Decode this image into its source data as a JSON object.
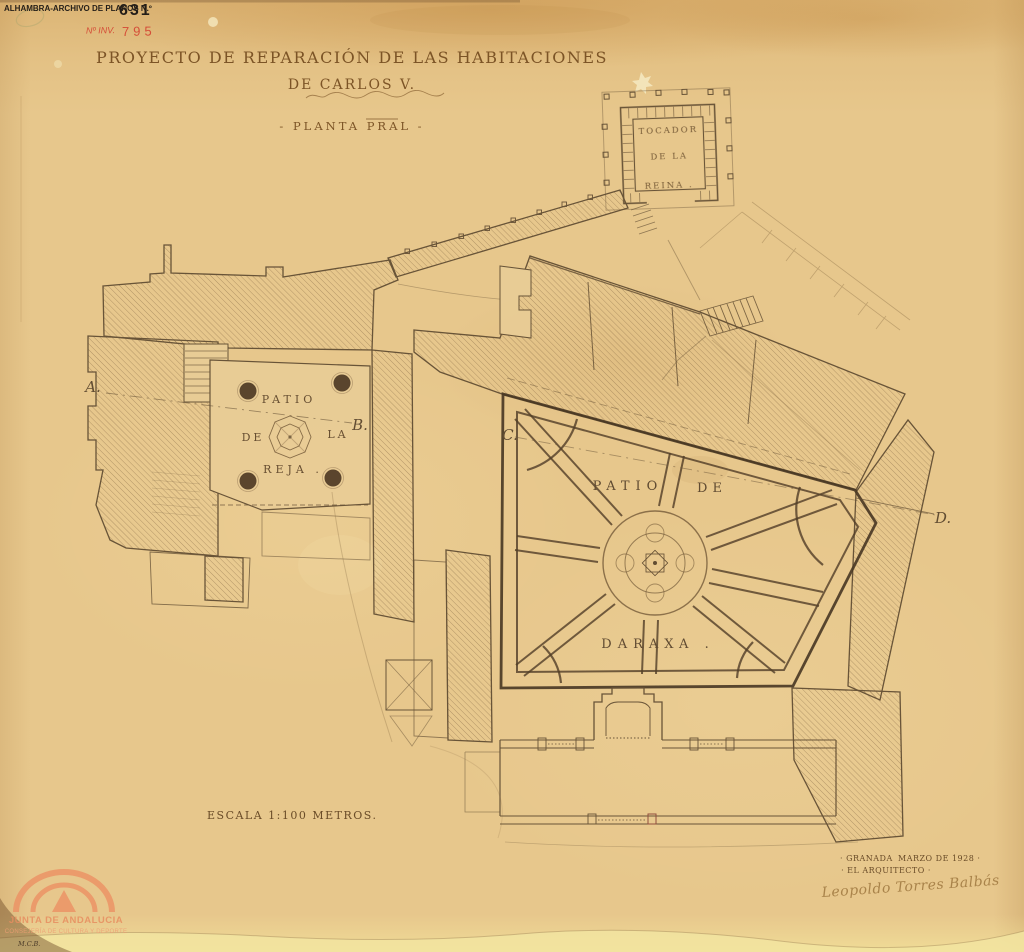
{
  "stamps": {
    "archive_label": "ALHAMBRA-ARCHIVO DE PLANOS N.º",
    "archive_number": "631",
    "inventory_label": "Nº INV.",
    "inventory_number": "795"
  },
  "title": {
    "line1": "PROYECTO DE REPARACIÓN DE LAS HABITACIONES",
    "line2": "DE CARLOS V.",
    "subtitle": "- PLANTA PRAL -"
  },
  "plan": {
    "tocador_l1": "TOCADOR",
    "tocador_l2": "DE LA",
    "tocador_l3": "REINA .",
    "reja_w1": "PATIO",
    "reja_w2": "DE",
    "reja_w3": "LA",
    "reja_w4": "REJA .",
    "daraxa_w1": "PATIO",
    "daraxa_w2": "DE",
    "daraxa_l2": "DARAXA .",
    "section_a": "A.",
    "section_b": "B.",
    "section_c": "C.",
    "section_d": "D.",
    "scale_note": "ESCALA 1:100 METROS."
  },
  "signature_block": {
    "place": "· GRANADA",
    "date": "MARZO DE 1928 ·",
    "role": "· EL ARQUITECTO ·",
    "signature": "Leopoldo Torres Balbás"
  },
  "watermark": {
    "org": "JUNTA DE ANDALUCIA",
    "dept": "CONSEJERÍA DE CULTURA Y DEPORTE",
    "initials": "M.C.B."
  },
  "colors": {
    "paper": "#e7c78c",
    "ink": "#5d4930",
    "ink_dark": "#3c2c1a",
    "stamp_black": "#241e18",
    "stamp_red": "#d54e38",
    "watermark_orange": "#ec9466",
    "signature_ink": "#a9834a"
  }
}
